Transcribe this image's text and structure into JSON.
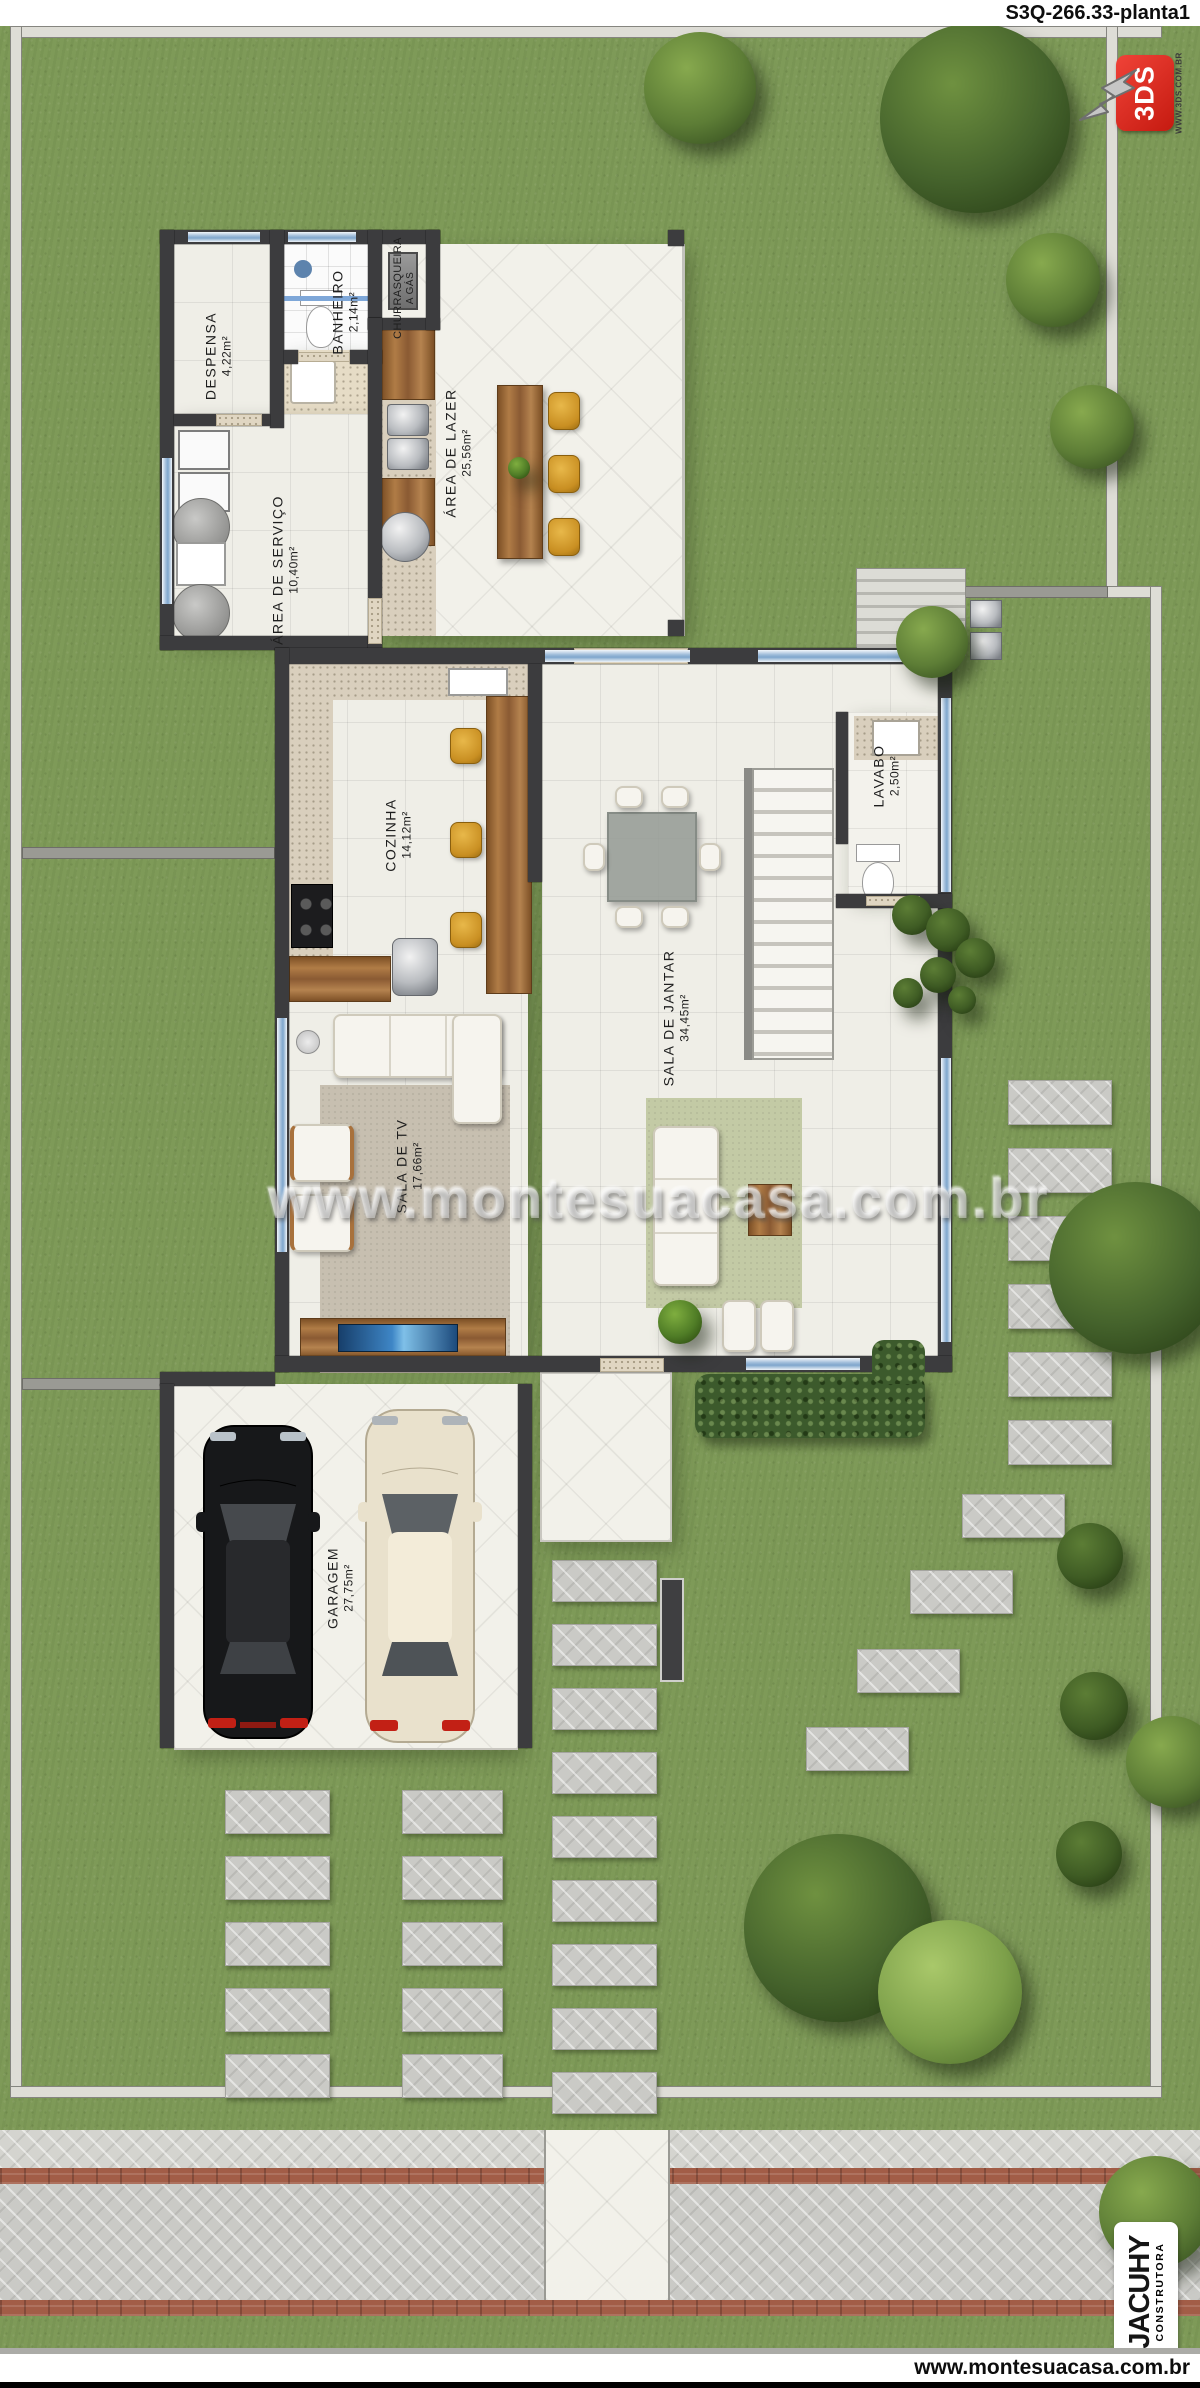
{
  "title": {
    "plan_code": "S3Q-266.33-planta1"
  },
  "logo_3ds": {
    "brand": "3DS",
    "site": "WWW.3DS.COM.BR"
  },
  "rooms": {
    "despensa": {
      "name": "DESPENSA",
      "area": "4,22m²"
    },
    "banheiro": {
      "name": "BANHEIRO",
      "area": "2,14m²"
    },
    "churrasqueira": {
      "name": "CHURRASQUEIRA",
      "area": "A GÁS"
    },
    "area_servico": {
      "name": "ÁREA DE SERVIÇO",
      "area": "10,40m²"
    },
    "area_lazer": {
      "name": "ÁREA DE LAZER",
      "area": "25,56m²"
    },
    "cozinha": {
      "name": "COZINHA",
      "area": "14,12m²"
    },
    "lavabo": {
      "name": "LAVABO",
      "area": "2,50m²"
    },
    "sala_jantar": {
      "name": "SALA DE JANTAR",
      "area": "34,45m²"
    },
    "sala_tv": {
      "name": "SALA DE TV",
      "area": "17,66m²"
    },
    "garagem": {
      "name": "GARAGEM",
      "area": "27,75m²"
    }
  },
  "watermark": {
    "text": "www.montesuacasa.com.br"
  },
  "builder": {
    "name": "JACUHY",
    "subtitle": "CONSTRUTORA"
  },
  "footer": {
    "url": "www.montesuacasa.com.br"
  },
  "colors": {
    "accent_red": "#d42015",
    "builder_green": "#3f9c35",
    "grass": "#7e9a58",
    "window_blue": "#8fb3d9"
  }
}
